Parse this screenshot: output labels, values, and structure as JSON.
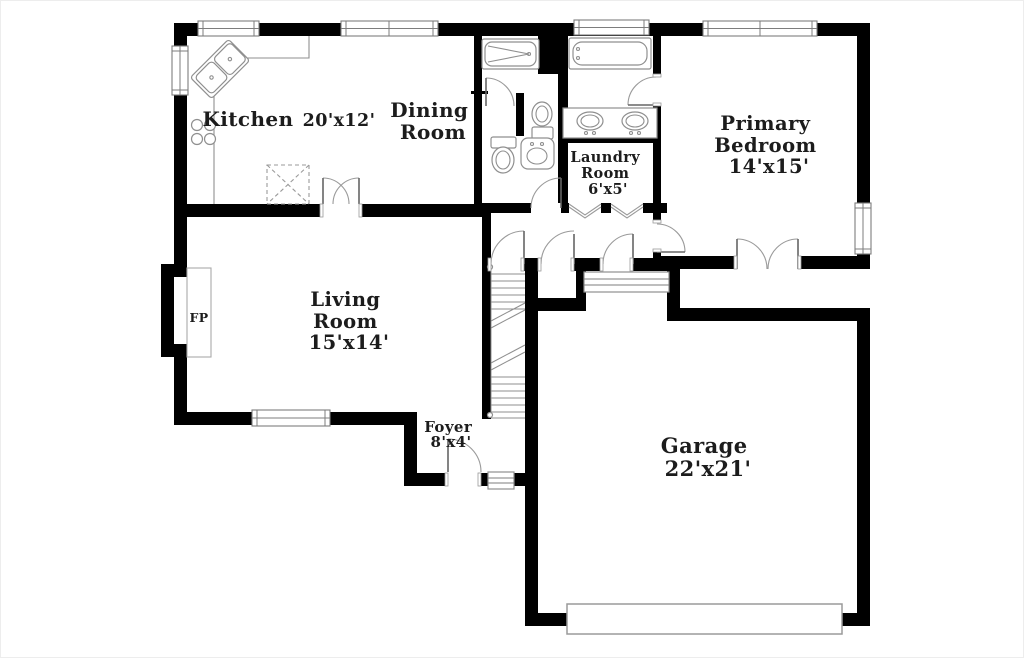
{
  "image": {
    "type": "residential-floor-plan",
    "width": 1024,
    "height": 658
  },
  "colors": {
    "walls": "#000000",
    "fixtures": "#8f8f8f",
    "door_arcs": "#9a9a9a",
    "text": "#1c1c1c",
    "background": "#ffffff"
  },
  "rooms": {
    "kitchen": {
      "name": "Kitchen",
      "dims": "20'x12'"
    },
    "dining_room": {
      "lines": [
        "Dining",
        "Room"
      ]
    },
    "laundry_room": {
      "lines": [
        "Laundry",
        "Room",
        "6'x5'"
      ]
    },
    "primary_bedroom": {
      "lines": [
        "Primary",
        "Bedroom",
        "14'x15'"
      ]
    },
    "living_room": {
      "lines": [
        "Living",
        "Room",
        "15'x14'"
      ]
    },
    "foyer": {
      "lines": [
        "Foyer",
        "8'x4'"
      ]
    },
    "garage": {
      "lines": [
        "Garage",
        "22'x21'"
      ]
    },
    "fireplace": {
      "abbr": "FP"
    }
  }
}
